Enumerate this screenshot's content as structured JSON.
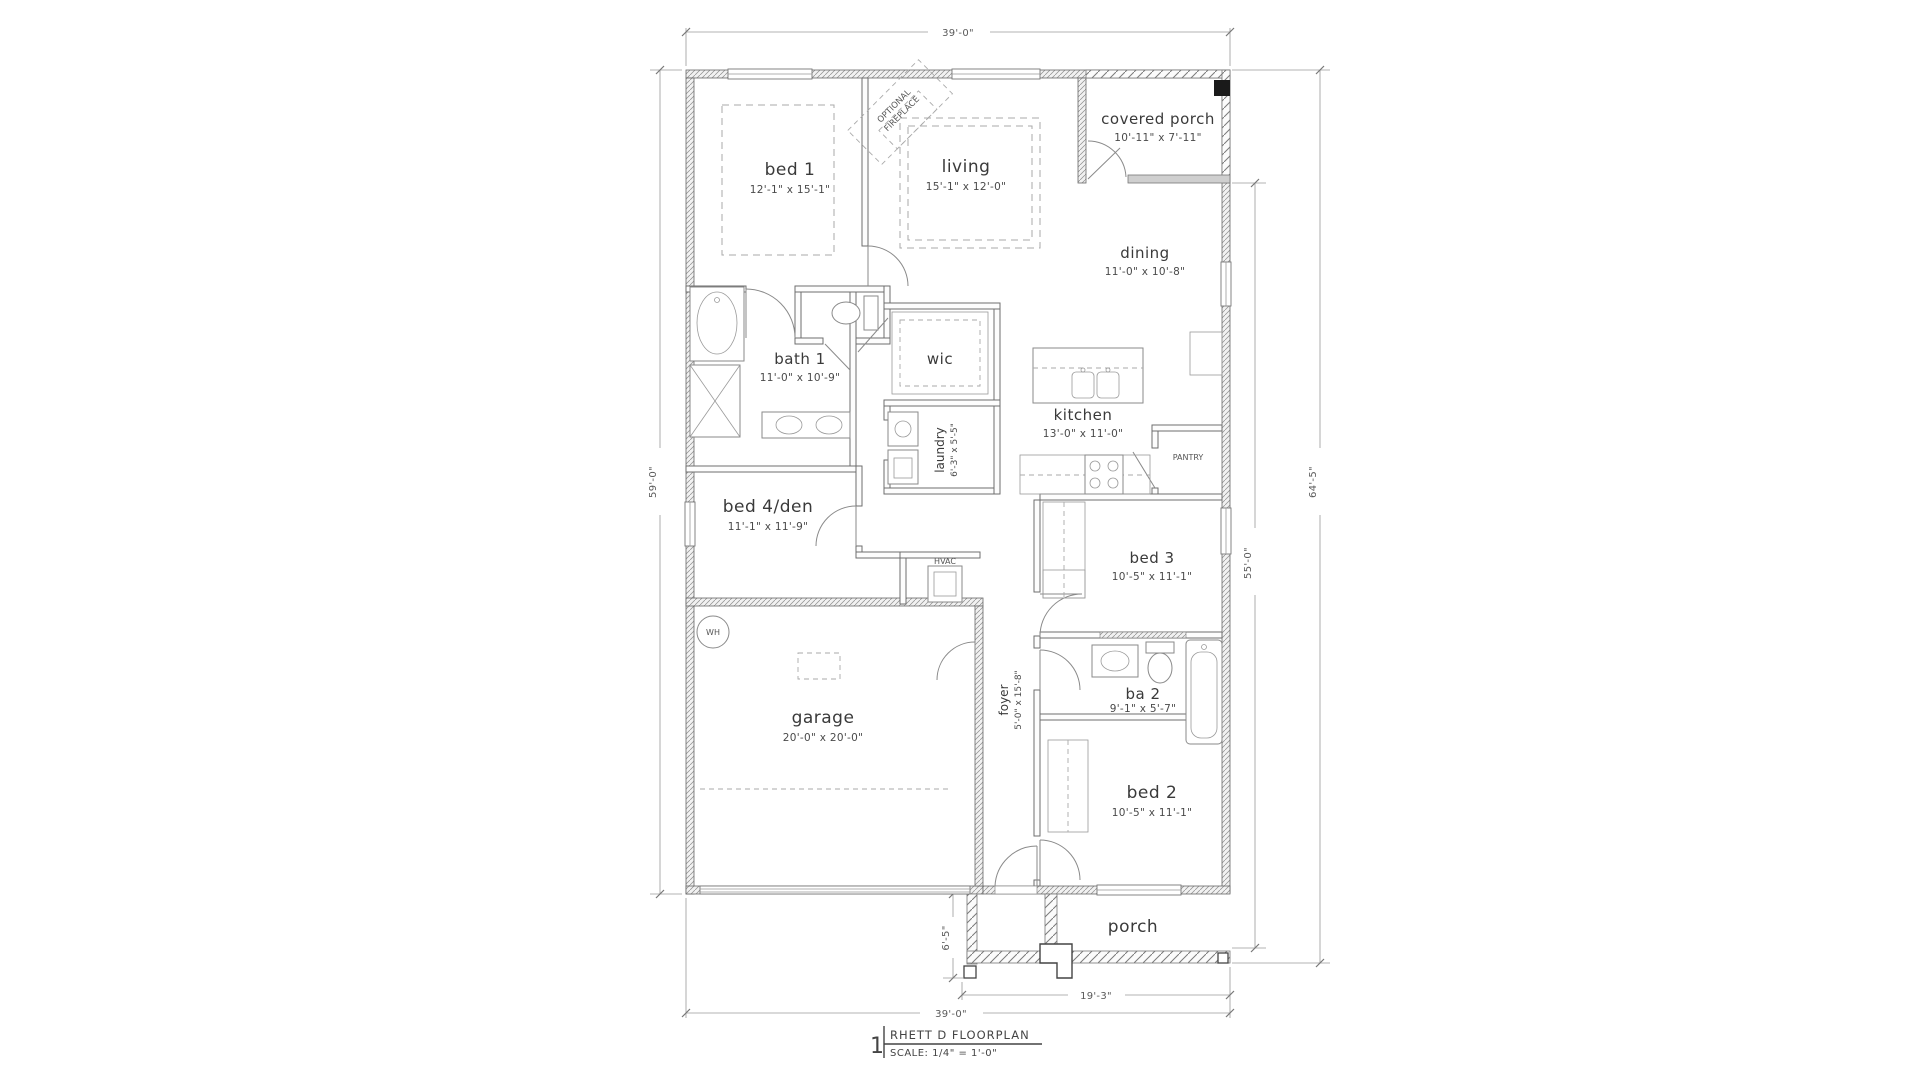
{
  "title_block": {
    "sheet_number": "1",
    "name": "RHETT D FLOORPLAN",
    "scale": "SCALE: 1/4\" = 1'-0\""
  },
  "rooms": {
    "bed1": {
      "name": "bed 1",
      "dims": "12'-1\" x 15'-1\""
    },
    "living": {
      "name": "living",
      "dims": "15'-1\" x 12'-0\""
    },
    "covered_porch": {
      "name": "covered porch",
      "dims": "10'-11\" x 7'-11\""
    },
    "dining": {
      "name": "dining",
      "dims": "11'-0\" x 10'-8\""
    },
    "kitchen": {
      "name": "kitchen",
      "dims": "13'-0\" x 11'-0\""
    },
    "pantry": {
      "name": "PANTRY"
    },
    "bath1": {
      "name": "bath 1",
      "dims": "11'-0\" x 10'-9\""
    },
    "wic": {
      "name": "wic"
    },
    "laundry": {
      "name": "laundry",
      "dims": "6'-3\" x 5'-5\""
    },
    "bed4": {
      "name": "bed 4/den",
      "dims": "11'-1\" x 11'-9\""
    },
    "hvac": {
      "name": "HVAC"
    },
    "wh": {
      "name": "WH"
    },
    "garage": {
      "name": "garage",
      "dims": "20'-0\" x 20'-0\""
    },
    "foyer": {
      "name": "foyer",
      "dims": "5'-0\" x 15'-8\""
    },
    "bed3": {
      "name": "bed 3",
      "dims": "10'-5\" x 11'-1\""
    },
    "ba2": {
      "name": "ba 2",
      "dims": "9'-1\" x 5'-7\""
    },
    "bed2": {
      "name": "bed 2",
      "dims": "10'-5\" x 11'-1\""
    },
    "porch": {
      "name": "porch"
    },
    "fireplace": {
      "line1": "OPTIONAL",
      "line2": "FIREPLACE"
    }
  },
  "dimensions": {
    "top_width": "39'-0\"",
    "left_height": "59'-0\"",
    "right_inner": "55'-0\"",
    "right_outer": "64'-5\"",
    "porch_depth": "6'-5\"",
    "porch_width": "19'-3\"",
    "bottom_width": "39'-0\""
  },
  "colors": {
    "background": "#ffffff",
    "wall_line": "#6e6e6e",
    "text": "#3a3a3a",
    "dim_line": "#9a9a9a",
    "column": "#1a1a1a"
  }
}
